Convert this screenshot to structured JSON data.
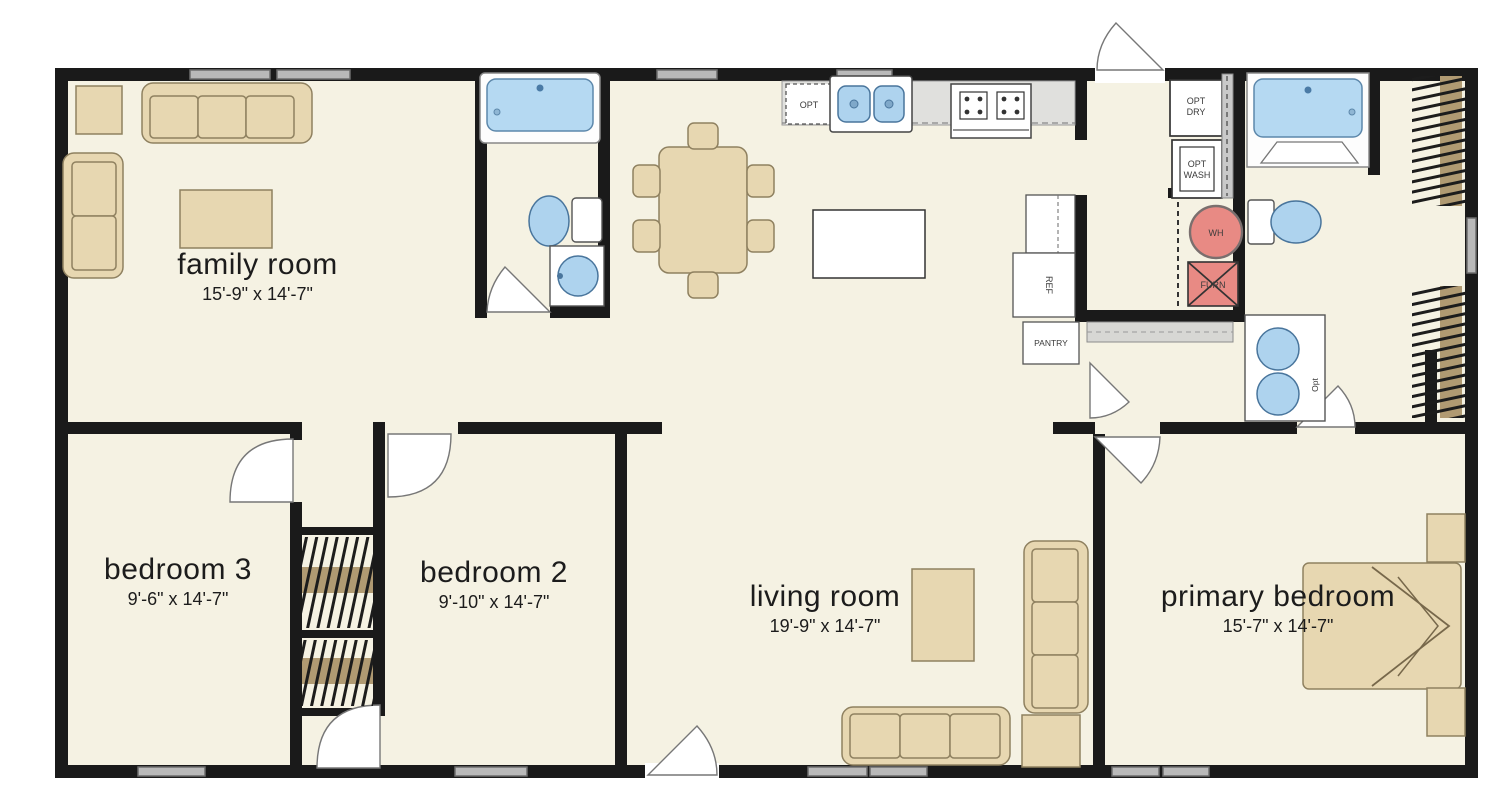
{
  "plan_title": "single-story home floor plan",
  "rooms": [
    {
      "name": "family room",
      "dims": "15'-9\" x 14'-7\""
    },
    {
      "name": "bedroom 3",
      "dims": "9'-6\" x 14'-7\""
    },
    {
      "name": "bedroom 2",
      "dims": "9'-10\" x 14'-7\""
    },
    {
      "name": "living room",
      "dims": "19'-9\" x 14'-7\""
    },
    {
      "name": "primary bedroom",
      "dims": "15'-7\" x 14'-7\""
    }
  ],
  "labels": {
    "opt_dishwasher": "OPT",
    "ref": "REF",
    "pantry": "PANTRY",
    "opt_dry_1": "OPT",
    "opt_dry_2": "DRY",
    "opt_wash_1": "OPT",
    "opt_wash_2": "WASH",
    "wh": "WH",
    "furn": "FURN",
    "opt_vanity": "Opt"
  },
  "colors": {
    "wall": "#1a1a1a",
    "floor": "#f5f2e3",
    "furniture_tan": "#e7d7b1",
    "furniture_border": "#8f8160",
    "fixture_blue": "#aed3ee",
    "fixture_blue_border": "#49759c",
    "tub_blue": "#b5d9f2",
    "utility_red": "#e88a84",
    "window_gray": "#b9b9b9",
    "counter_gray": "#e0e0dd",
    "closet_rod_brown": "#b09a72"
  }
}
